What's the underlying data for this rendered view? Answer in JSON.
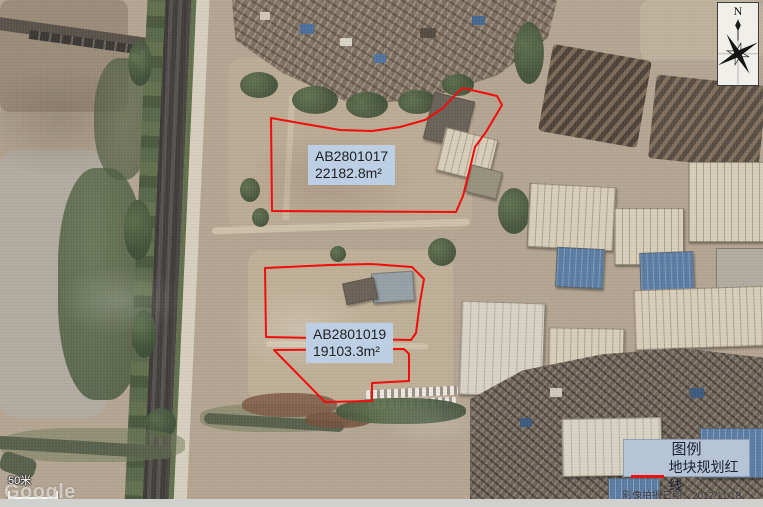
{
  "annotations": {
    "parcels": [
      {
        "id": "AB2801017",
        "area_label": "22182.8m²",
        "outline_path": "M271,118 L305,124 L340,130 L372,131 L400,127 L425,120 L443,108 L457,93 L463,88 L497,96 L502,105 L486,132 L475,147 L470,168 L463,196 L456,212 L272,211 Z"
      },
      {
        "id": "AB2801019",
        "area_label": "19103.3m²",
        "outline_path": "M265,268 L330,265 L371,264 L412,267 L424,279 L420,302 L416,333 L411,340 L266,337 Z M274,350 L404,349 L409,354 L409,381 L372,383 L372,401 L325,402 Z"
      }
    ]
  },
  "legend": {
    "title": "图例",
    "items": [
      {
        "label": "地块规划红线",
        "color": "#ee1111"
      }
    ]
  },
  "compass": {
    "north_label": "N"
  },
  "scale_bar": {
    "label": "50米"
  },
  "watermarks": {
    "imagery_provider": "Google",
    "imagery_date_label": "影像拍摄日期：2017/11/18"
  },
  "colors": {
    "parcel_outline": "#f20d0d",
    "annotation_label_bg": "#bdcfe5",
    "legend_bg": "#b6c4d8"
  }
}
